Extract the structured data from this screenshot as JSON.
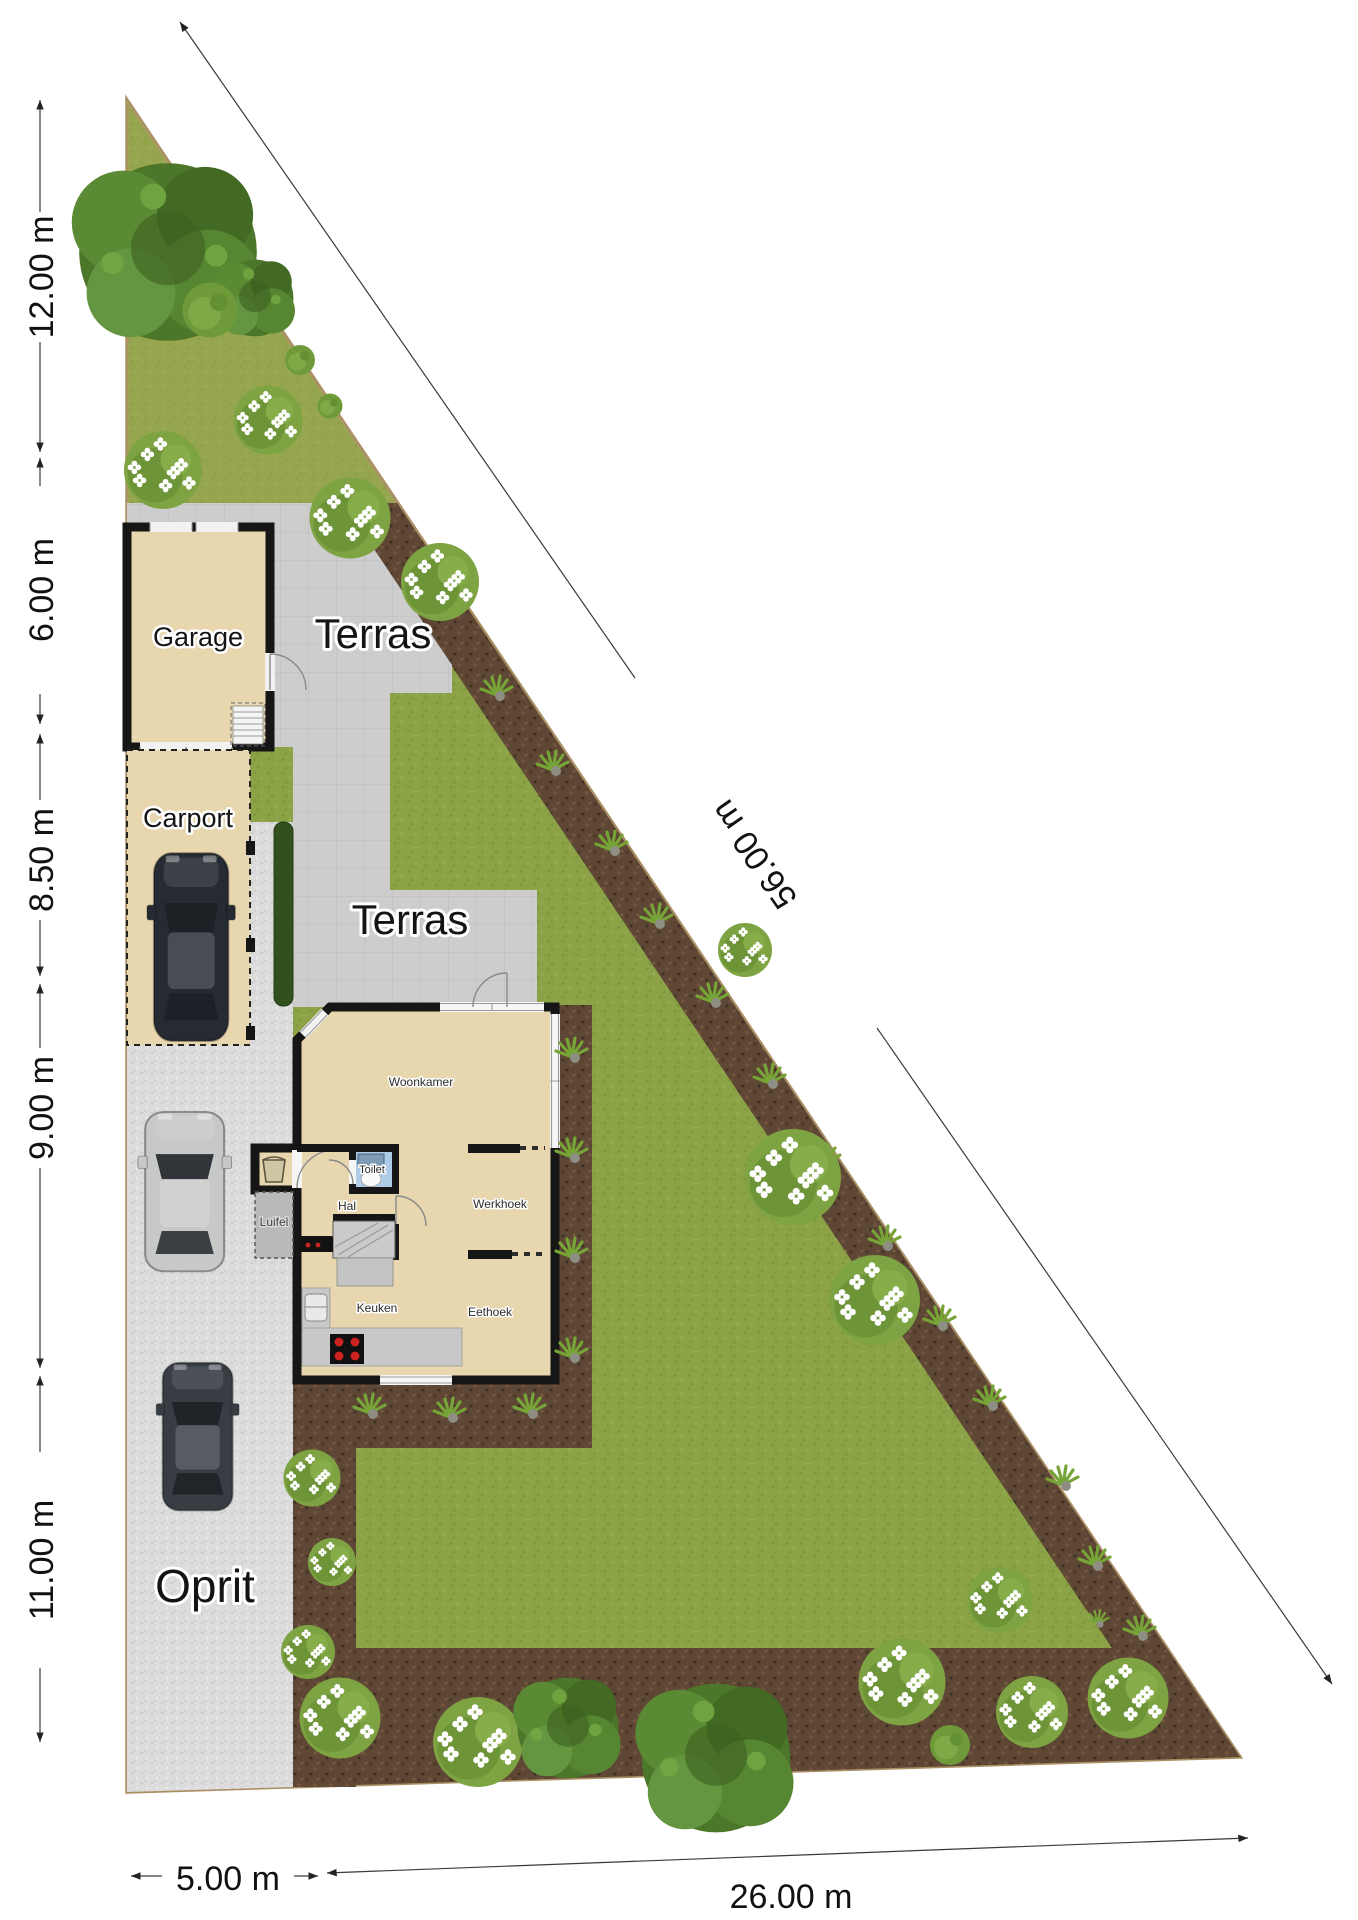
{
  "plan": {
    "labels": {
      "garage": "Garage",
      "carport": "Carport",
      "terras": "Terras",
      "oprit": "Oprit",
      "luifel": "Luifel",
      "woonkamer": "Woonkamer",
      "toilet": "Toilet",
      "hal": "Hal",
      "werkhoek": "Werkhoek",
      "keuken": "Keuken",
      "eethoek": "Eethoek"
    },
    "dimensions": {
      "left": [
        "12.00 m",
        "6.00 m",
        "8.50 m",
        "9.00 m",
        "11.00 m"
      ],
      "diagonal": "56.00 m",
      "bottom": [
        "5.00 m",
        "26.00 m"
      ]
    },
    "colors": {
      "lawn": "#8ba246",
      "lawn_upper": "#a9ae5e",
      "mulch": "#5e4734",
      "terrace": "#cccdcc",
      "gravel": "#dbdcdb",
      "building": "#e7d6ae",
      "wall": "#161616",
      "toilet_blue": "#aecbe8",
      "hedge": "#324f1e",
      "boundary": "#a98f63",
      "car_carport": "#262b33",
      "car_silver": "#c7c9c8",
      "car_dark": "#383d44"
    }
  }
}
